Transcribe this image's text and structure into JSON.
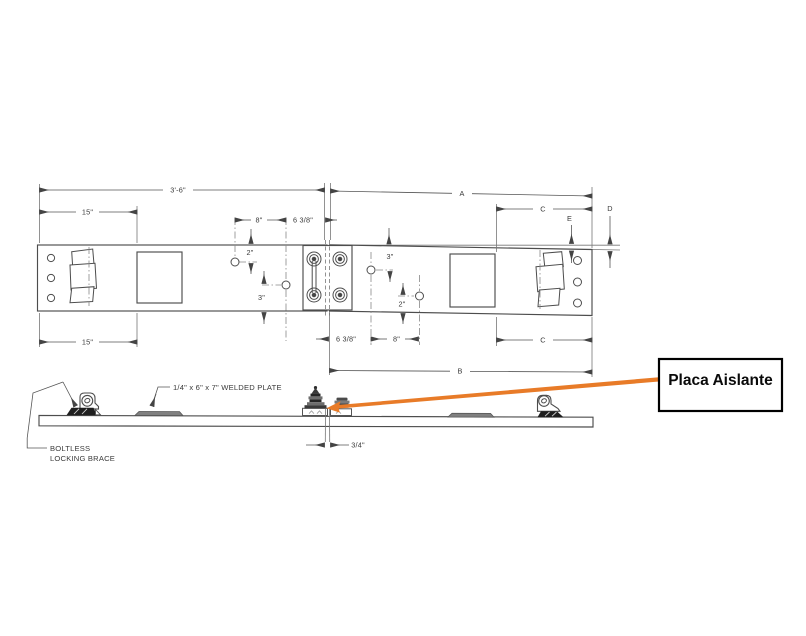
{
  "drawing": {
    "dims": {
      "d36": "3'-6\"",
      "d15_top": "15\"",
      "d8_top": "8\"",
      "d638_top": "6 3/8\"",
      "d2_left": "2\"",
      "d3_left": "3\"",
      "a": "A",
      "c_top": "C",
      "e": "E",
      "d": "D",
      "d3_right": "3\"",
      "d2_right": "2\"",
      "d15_bot": "15\"",
      "d638_bot": "6 3/8\"",
      "d8_bot": "8\"",
      "b": "B",
      "c_bot": "C",
      "d34": "3/4\""
    },
    "notes": {
      "welded_plate": "1/4\" x 6\" x 7\" WELDED PLATE",
      "brace_line1": "BOLTLESS",
      "brace_line2": "LOCKING BRACE"
    },
    "callout": {
      "label": "Placa Aislante",
      "arrow_color": "#E87B28"
    },
    "colors": {
      "line": "#4d4d4d",
      "welded_plate_fill": "#808080",
      "hardware_dark": "#1f1f1f",
      "callout_border": "#000000"
    }
  }
}
